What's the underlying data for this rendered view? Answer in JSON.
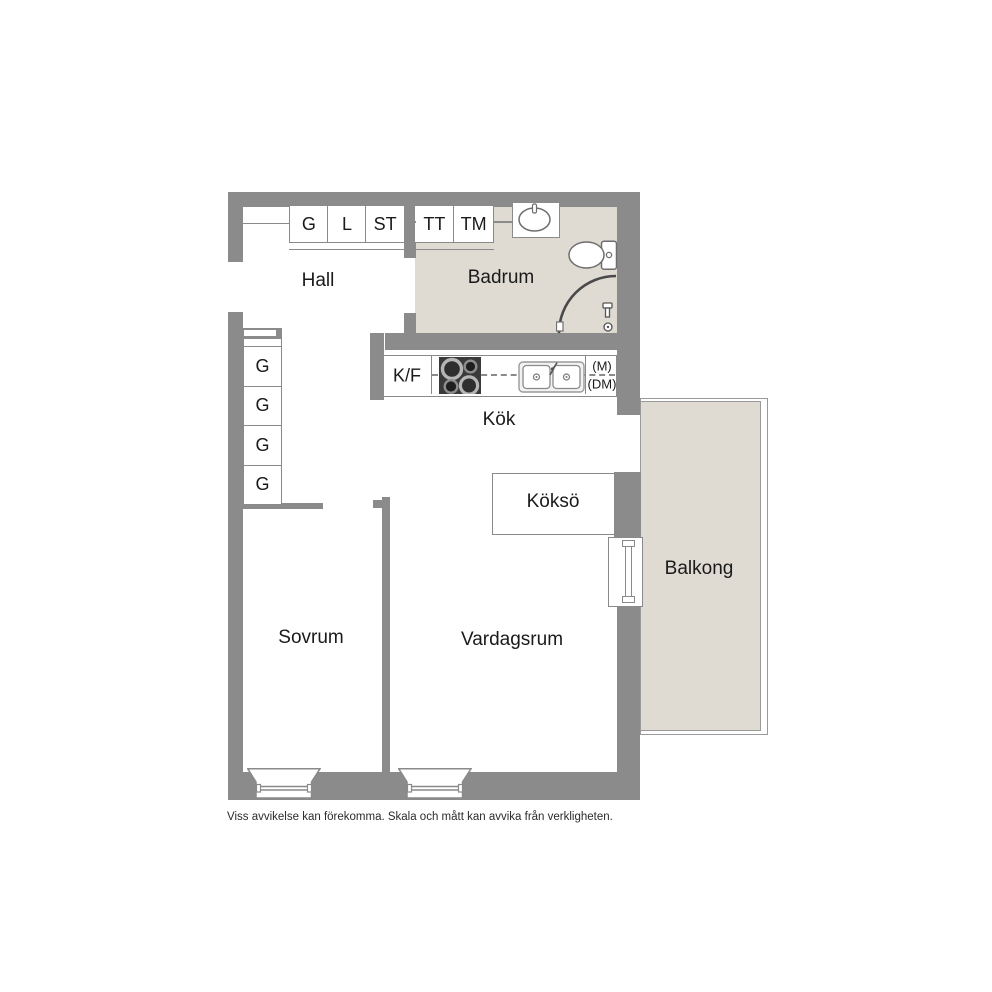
{
  "plan": {
    "rooms": {
      "hall": "Hall",
      "badrum": "Badrum",
      "kok": "Kök",
      "kokso": "Köksö",
      "balkong": "Balkong",
      "sovrum": "Sovrum",
      "vardagsrum": "Vardagsrum"
    },
    "closets": {
      "g": "G",
      "l": "L",
      "st": "ST",
      "tt": "TT",
      "tm": "TM"
    },
    "wardrobe_column": [
      "G",
      "G",
      "G",
      "G"
    ],
    "kitchen": {
      "kf": "K/F",
      "m": "(M)",
      "dm": "(DM)"
    }
  },
  "footer": {
    "disclaimer": "Viss avvikelse kan förekomma. Skala och mått kan avvika från verkligheten."
  },
  "colors": {
    "wall": "#8b8b8b",
    "floor_tint": "#dfdbd3",
    "outline": "#8a8a8a",
    "text": "#1a1a1a",
    "stove": "#3a3a3a"
  }
}
